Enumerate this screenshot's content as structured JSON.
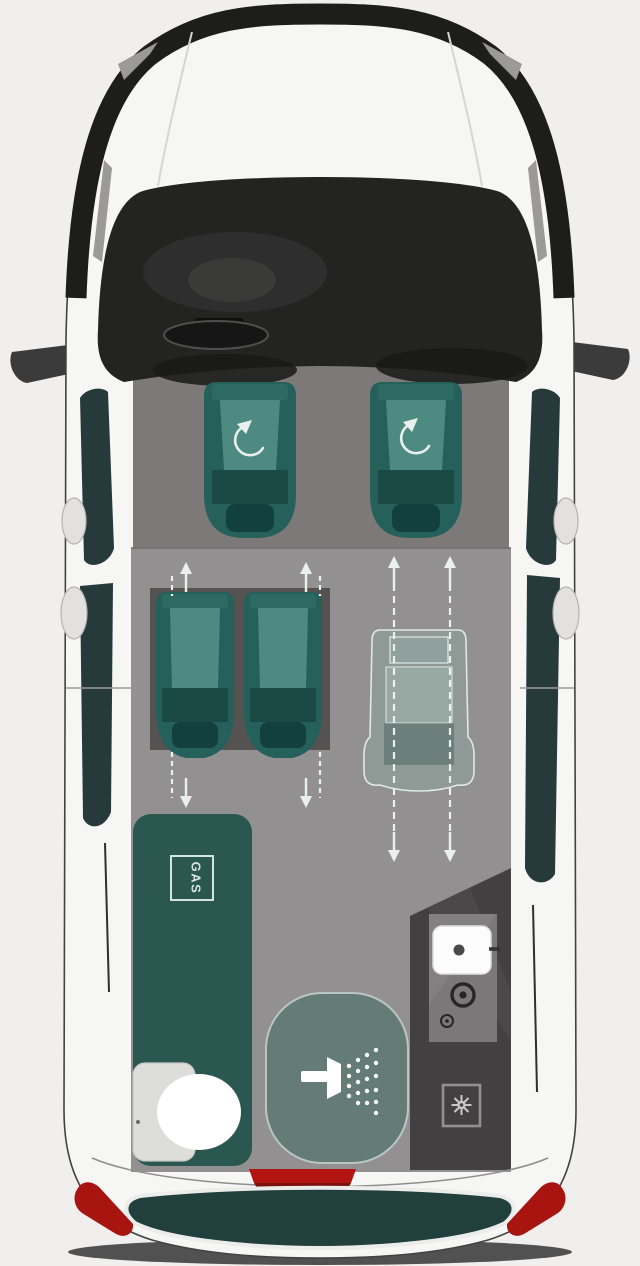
{
  "floorplan": {
    "description": "campervan-top-view-floorplan",
    "gas_label": "GAS",
    "icon_names": [
      "swivel-arrow-icon",
      "slide-up-arrow-icon",
      "slide-down-arrow-icon",
      "seat-rail-icon",
      "gas-locker-icon",
      "toilet-icon",
      "shower-head-icon",
      "sink-icon",
      "gas-burner-icon",
      "power-socket-icon",
      "heater-icon",
      "side-mirror-icon",
      "brake-light-icon",
      "taillight-icon"
    ],
    "colors": {
      "background": "#f0efee",
      "body": "#f6f6f5",
      "outline": "#424242",
      "front_trim": "#1d1d1c",
      "glass_dark": "#232322",
      "cab_floor": "#7c7978",
      "floor": "#929090",
      "window_tint": "#26393b",
      "seat_teal": "#25615a",
      "seat_cushion": "#4d8b82",
      "seat_dark": "#12403c",
      "plinth": "#555352",
      "kitchen_teal": "#2b5751",
      "shower_pod": "#647b76",
      "shower_rim": "#b9c6c2",
      "panel_dark": "#424041",
      "arrow": "#e9f0ee",
      "label_teal": "#d5e4e0",
      "red_light": "#a81410",
      "brake_red": "#b21511",
      "rear_step": "#203f3d",
      "white": "#ffffff",
      "mirror_dark": "#3c3b3b"
    }
  }
}
